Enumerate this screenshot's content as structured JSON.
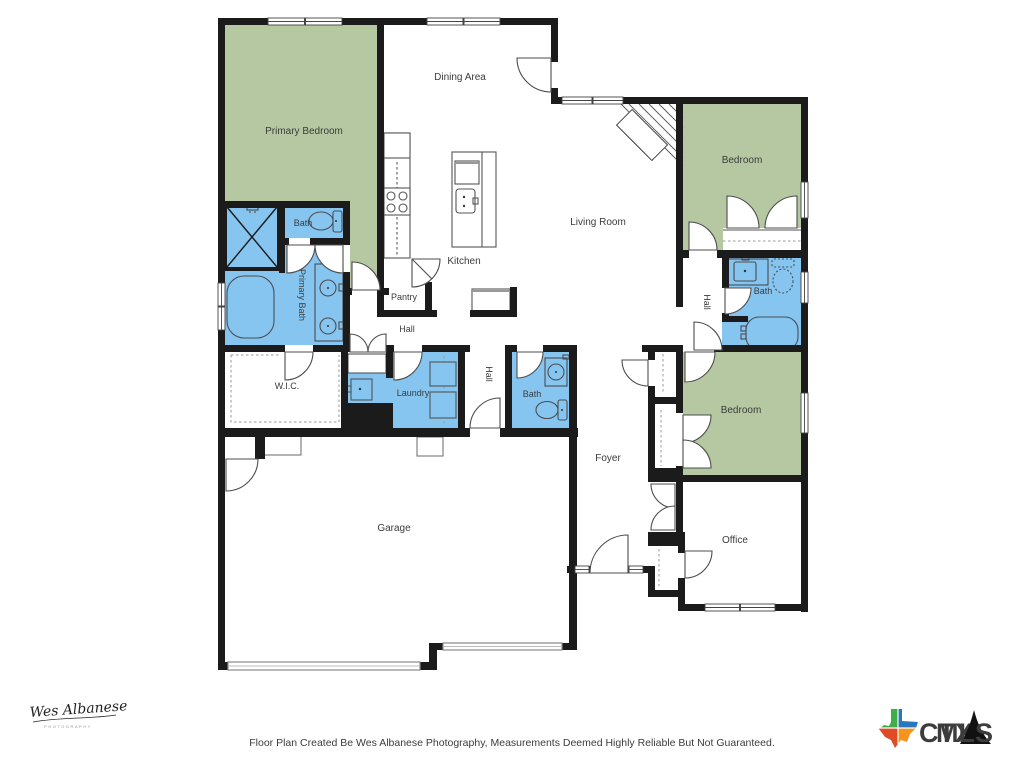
{
  "floor_plan": {
    "rooms": {
      "primary_bedroom": "Primary Bedroom",
      "dining_area": "Dining Area",
      "bedroom_top": "Bedroom",
      "living_room": "Living Room",
      "kitchen": "Kitchen",
      "bath_primary_wc": "Bath",
      "primary_bath": "Primary Bath",
      "pantry": "Pantry",
      "hall_kitchen": "Hall",
      "hall_center": "Hall",
      "hall_right": "Hall",
      "wic": "W.I.C.",
      "laundry": "Laundry",
      "bath_center": "Bath",
      "bath_right": "Bath",
      "foyer": "Foyer",
      "bedroom_bottom": "Bedroom",
      "office": "Office",
      "garage": "Garage"
    },
    "colors": {
      "bedroom_fill": "#b5c8a2",
      "bath_fill": "#85c5f0",
      "wall": "#1b1b1b",
      "line": "#4d4d4d",
      "label": "#3c3c3c"
    }
  },
  "footer": {
    "disclaimer": "Floor Plan Created Be Wes Albanese Photography, Measurements Deemed Highly Reliable But Not Guaranteed."
  },
  "branding": {
    "photographer_signature": "Wes Albanese",
    "photographer_subtext": "PHOTOGRAPHY",
    "mls_logo": {
      "ctx": "CTX",
      "mls": "MLS",
      "ctx_color": "#f7941d",
      "mls_color": "#1b75ba",
      "texas_green": "#3fae49",
      "texas_blue": "#2778bd",
      "texas_red": "#e04b26",
      "texas_orange": "#f7941d"
    }
  }
}
